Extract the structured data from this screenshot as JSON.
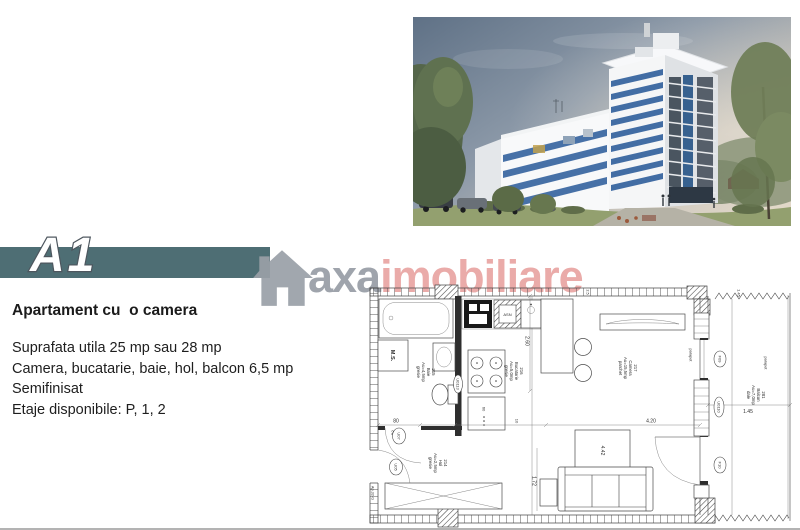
{
  "banner": {
    "label": "A1"
  },
  "logo": {
    "brand": "axa",
    "brand_suffix": "imobiliare",
    "icon": "house-icon"
  },
  "details": {
    "title": "Apartament cu  o camera",
    "lines": [
      "Suprafata utila 25 mp sau 28 mp",
      "Camera, bucatarie, baie, hol, balcon 6,5 mp",
      "Semifinisat",
      "Etaje disponibile: P, 1, 2"
    ]
  },
  "floor_plan": {
    "apartment_label": "Ap.32-G",
    "rooms": [
      {
        "number": "215",
        "name": "Baie",
        "area": "Au=4,5mp",
        "floor": "gresie"
      },
      {
        "number": "216",
        "name": "Bucatarie",
        "area": "Au=5,0mp",
        "floor": "gresie"
      },
      {
        "number": "217",
        "name": "Camera",
        "area": "Au=15,5mp",
        "floor": "parchet"
      },
      {
        "number": "214",
        "name": "Hol",
        "area": "Au=2,5mp",
        "floor": "gresie"
      },
      {
        "number": "281",
        "name": "Balcon",
        "area": "Au=7,0mp",
        "floor": "dale"
      }
    ],
    "door_labels": {
      "entrance": "U05",
      "bathroom": "U07",
      "bathroom_wall": "U0113",
      "balcony": "U0110"
    },
    "window_labels": {
      "upper": "F09",
      "lower": "F10"
    },
    "fixture_labels": {
      "washing_machine": "M.S.",
      "kitchen_unit": "ASN",
      "railing": "parapet"
    },
    "dims": {
      "door": "80",
      "bath_width": "2.10",
      "wall": "10",
      "camera_width": "4.20",
      "kitchen_depth": "2.60",
      "sofa_zone": "1.72",
      "camera_cross": "4.42",
      "balcony_width": "1.45",
      "balcony_top": "1.45",
      "cabinet": "60",
      "top_small": "2.5"
    }
  },
  "colors": {
    "banner": "#4e6e74",
    "logo_gray": "#9aa0a8",
    "logo_pink": "#e9a7a5",
    "accent_blue": "#2f5f9c",
    "sky_top": "#5f7186",
    "sky_horizon": "#d9d2c4",
    "grass": "#93a06f",
    "plan_line": "#3f3f3f"
  }
}
